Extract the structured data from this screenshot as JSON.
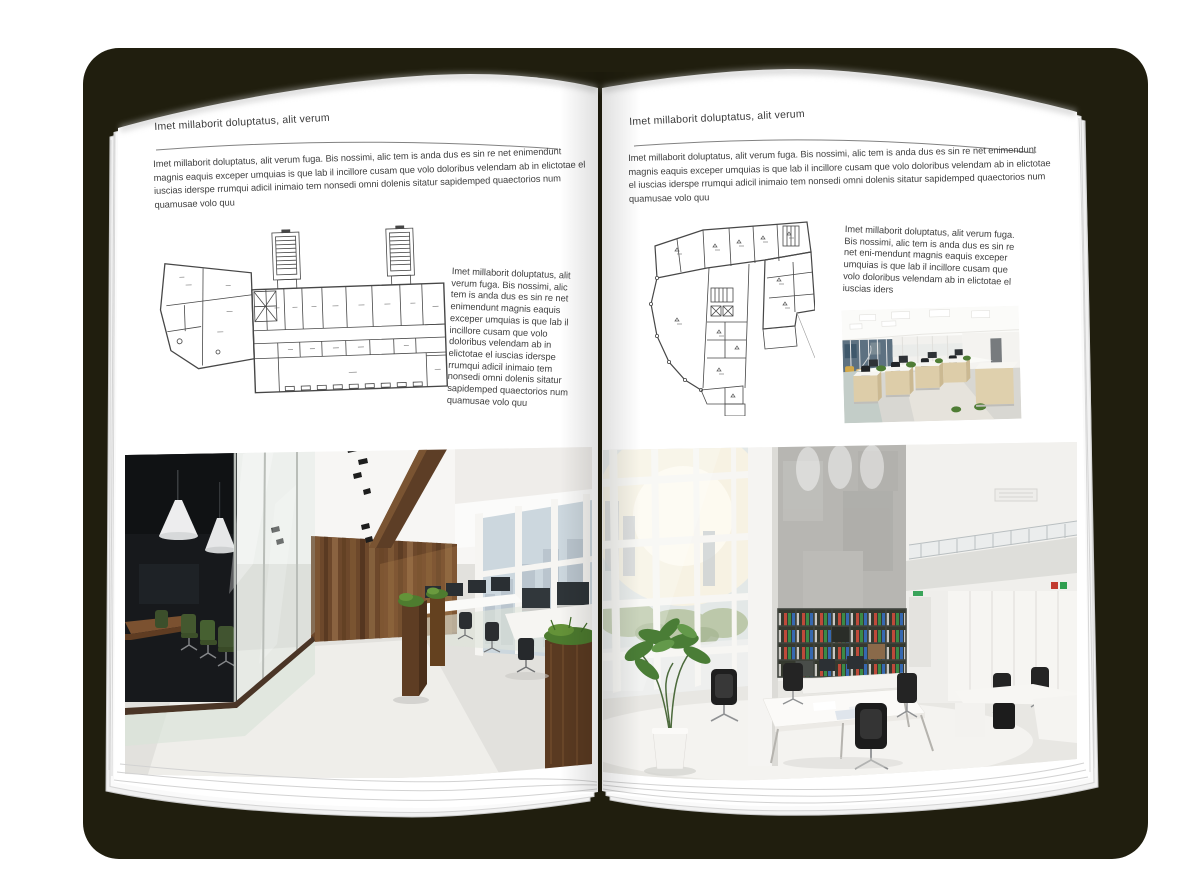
{
  "canvas": {
    "width": 1200,
    "height": 891,
    "background": "#ffffff"
  },
  "book": {
    "shadow_color": "#201e0e",
    "paper_color": "#ffffff",
    "text_color": "#3f3f3f",
    "rule_color": "#828282",
    "plan_line_color": "#474747",
    "accent_wood_color": "#6d482b",
    "accent_green_color": "#4a7d36"
  },
  "left_page": {
    "header": "Imet millaborit doluptatus, alit verum",
    "intro": "Imet millaborit doluptatus, alit verum fuga. Bis nossimi, alic tem is anda dus es sin re net enimendunt magnis eaquis exceper umquias is que lab il incillore cusam que volo doloribus velendam ab in elictotae el iuscias iderspe rrumqui adicil inimaio tem nonsedi omni dolenis sitatur sapidemped quaectorios num quamusae volo quu",
    "side_text": "Imet millaborit doluptatus, alit verum fuga. Bis nossimi, alic tem is anda dus es sin re net enimendunt magnis eaquis exceper umquias is que lab il incillore cusam que volo doloribus velendam ab in elictotae el iuscias iderspe rrumqui adicil inimaio tem nonsedi omni dolenis sitatur sapidemped quaectorios num quamusae volo quu",
    "floorplan": "building-floor-plan-wide",
    "photo": "loft-office-interior-photo"
  },
  "right_page": {
    "header": "Imet millaborit doluptatus, alit verum",
    "intro": "Imet millaborit doluptatus, alit verum fuga. Bis nossimi, alic tem is anda dus es sin re net enimendunt magnis eaquis exceper umquias is que lab il incillore cusam que volo doloribus velendam ab in elictotae el iuscias iderspe rrumqui adicil inimaio tem nonsedi omni dolenis sitatur sapidemped quaectorios num quamusae volo quu",
    "side_text": "Imet millaborit doluptatus, alit verum fuga. Bis nossimi, alic tem is anda dus es sin re net eni-mendunt magnis eaquis exceper umquias is que lab il incillore cusam que volo doloribus velendam ab in elictotae el iuscias iders",
    "floorplan": "building-floor-plan-tall",
    "photo_small": "open-office-workstations-photo",
    "photo_large": "atrium-office-interior-photo"
  }
}
